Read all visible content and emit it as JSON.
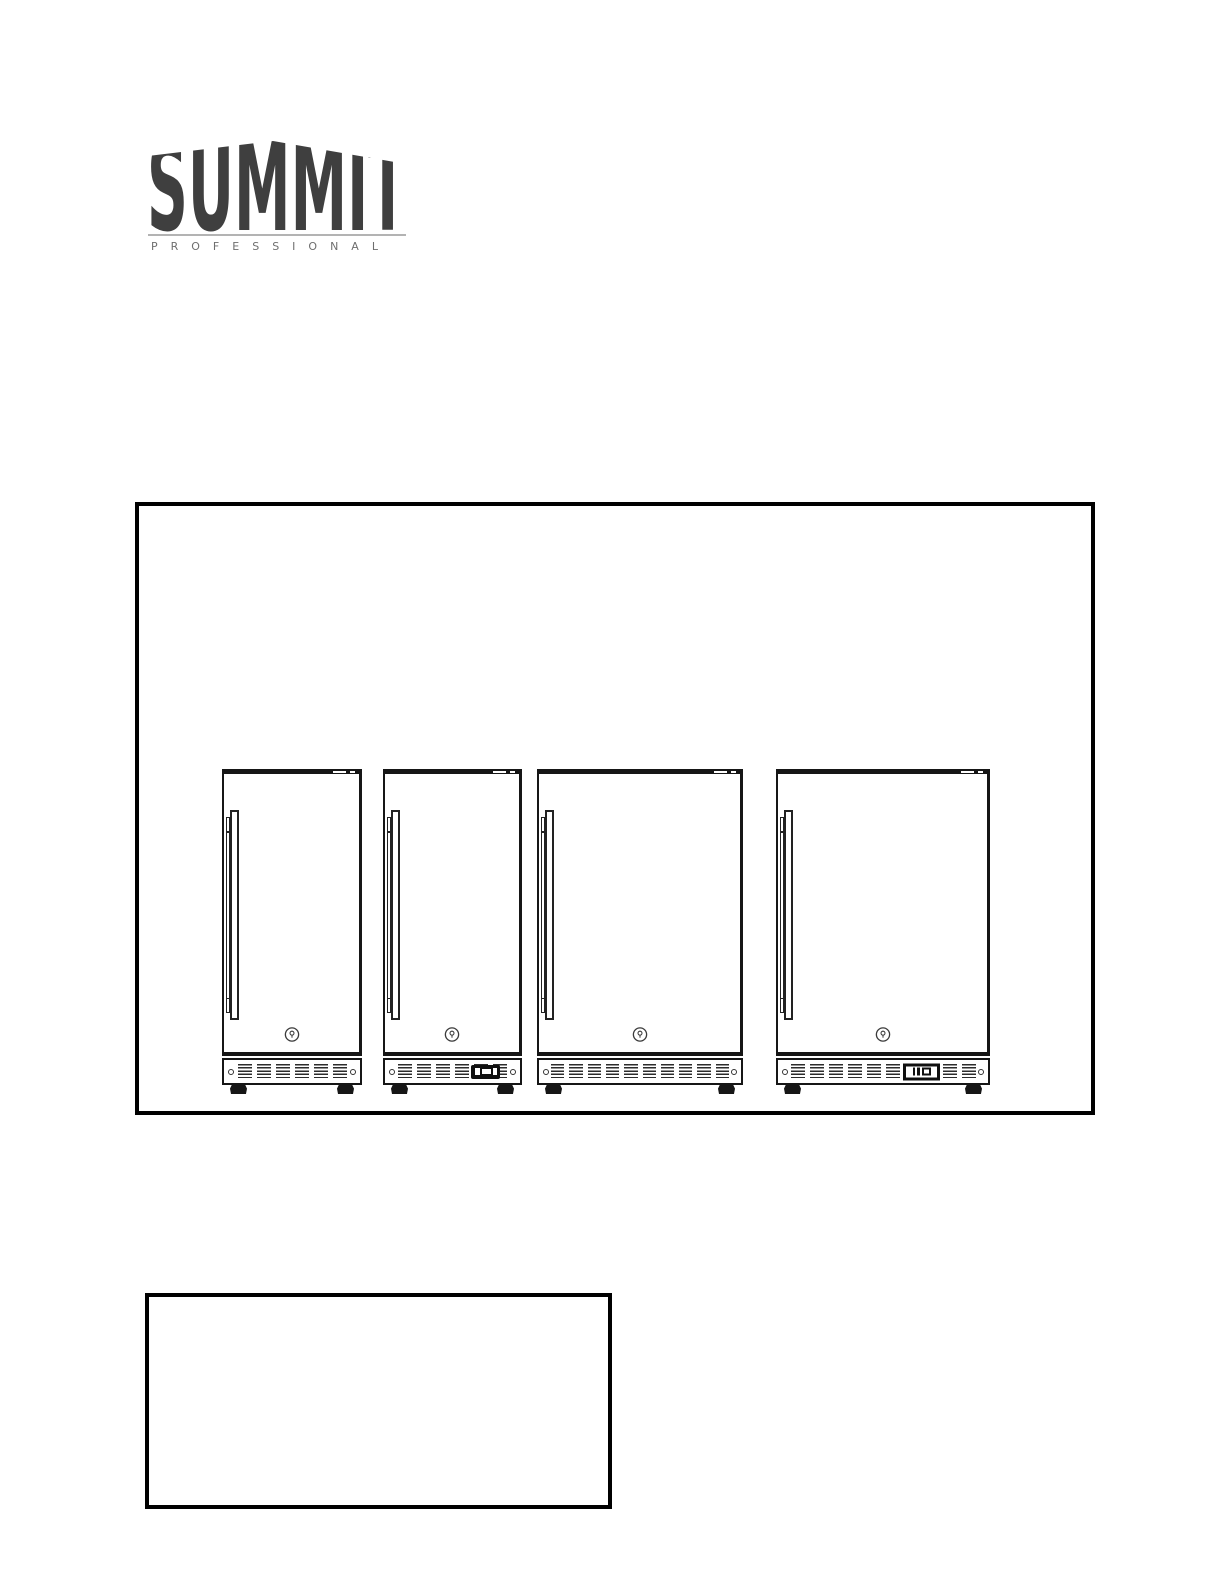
{
  "page": {
    "width": 1224,
    "height": 1584,
    "background": "#ffffff"
  },
  "logo": {
    "brand": "SUMMIT",
    "subbrand": "PROFESSIONAL",
    "brand_color": "#3f3f3f",
    "subbrand_color": "#6e6e6e",
    "divider_color": "#b3b3b3"
  },
  "colors": {
    "line_art": "#161616",
    "box_border": "#000000"
  },
  "illustration": {
    "fridge_top": 263,
    "fridge_height": 325,
    "fridges": [
      {
        "name": "compact-refrigerator-plain",
        "x": 83,
        "width": 140,
        "vent_groups": 6,
        "has_display": false,
        "display_style": "",
        "panel_right": 0
      },
      {
        "name": "compact-refrigerator-with-display",
        "x": 244,
        "width": 139,
        "vent_groups": 6,
        "has_display": true,
        "display_style": "dark",
        "panel_right": 20
      },
      {
        "name": "wide-refrigerator-plain",
        "x": 398,
        "width": 206,
        "vent_groups": 10,
        "has_display": false,
        "display_style": "",
        "panel_right": 0
      },
      {
        "name": "wide-refrigerator-with-display",
        "x": 637,
        "width": 214,
        "vent_groups": 10,
        "has_display": true,
        "display_style": "light",
        "panel_right": 48
      }
    ]
  },
  "note_box": {
    "content": ""
  }
}
